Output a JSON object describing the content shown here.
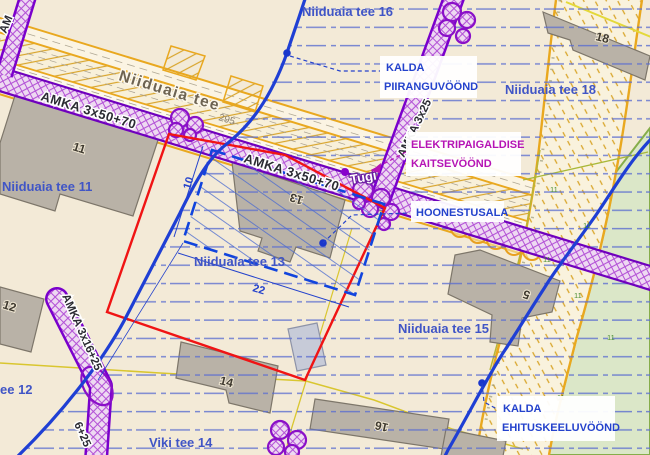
{
  "labels": {
    "road_name": "Niiduaia tee",
    "plot_16": "Niiduaia tee 16",
    "plot_18": "Niiduaia tee 18",
    "plot_11": "Niiduaia tee 11",
    "plot_13": "Niiduaia tee 13",
    "plot_15": "Niiduaia tee 15",
    "plot_12_partial": "ee 12",
    "viki_tee_14": "Viki tee 14",
    "cadastral_number": "295"
  },
  "annotations": {
    "kalda_piiranguvoond_line1": "KALDA",
    "kalda_piiranguvoond_line2": "PIIRANGUVÖÖND",
    "elektripaigaldise_line1": "ELEKTRIPAIGALDISE",
    "elektripaigaldise_line2": "KAITSEVÖÖND",
    "hoonestusala": "HOONESTUSALA",
    "kalda_ehituskeeluvoond_line1": "KALDA",
    "kalda_ehituskeeluvoond_line2": "EHITUSKEELUVÖÖND",
    "tugi": "Tugi"
  },
  "cables": {
    "amka_main_1": "AMKA 3x50+70",
    "amka_main_2": "AMKA 3x50+70",
    "amka_branch_up": "AMKA 3x25",
    "amka_branch_down": "AMKA 3x16+25",
    "amka_branch_down_partial": "6+25",
    "amka_edge_partial": "AM"
  },
  "building_numbers": {
    "b11": "11",
    "b12": "12",
    "b13": "13",
    "b14": "14",
    "b16": "16",
    "b5": "5",
    "b18": "18"
  },
  "dimensions": {
    "depth": "10",
    "width": "22"
  },
  "road_marks": {
    "m0": "11",
    "m1": "11",
    "m2": "11",
    "m3": "11",
    "m4": "11",
    "m5": "11"
  },
  "colors": {
    "background": "#f3ead7",
    "zone_hatch_blue": "#5b6ed0",
    "shore_line_blue": "#1f3fd4",
    "boundary_red": "#f01414",
    "cable_purple": "#7a00cc",
    "road_orange": "#e9a81f",
    "annotation_blue": "#2442cc",
    "annotation_magenta": "#b514b5",
    "building_gray": "#b9b2a7",
    "green_area": "#dbe7c8"
  }
}
